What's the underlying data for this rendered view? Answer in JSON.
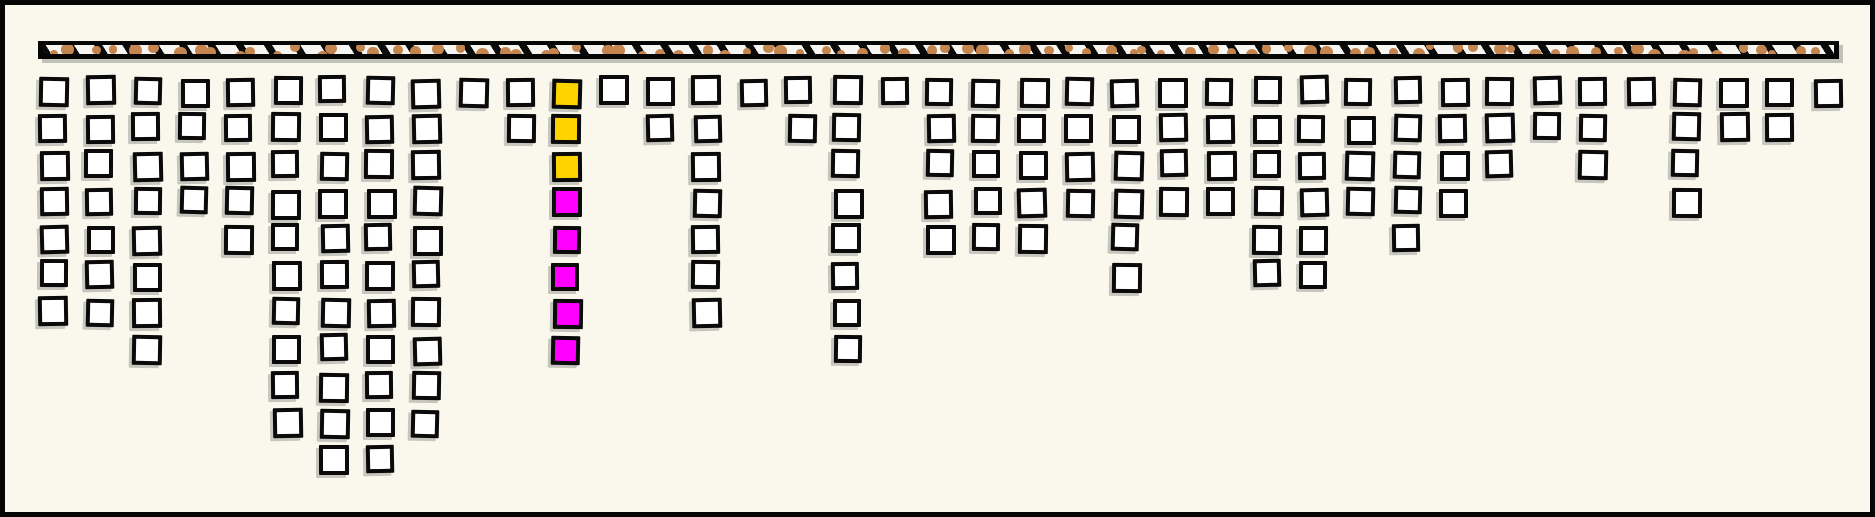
{
  "canvas": {
    "width": 1875,
    "height": 517,
    "background": "#FAF8EC",
    "border_color": "#060606"
  },
  "ceiling_strip": {
    "fill": "#F7F5F1",
    "hatch_style": "diagonal-black-dashes",
    "hatch_color": "#0a0a0a",
    "dot_color": "#C4854F",
    "edge_color": "#060606"
  },
  "cell_style": {
    "fill": "#FFFFFF",
    "edge_color": "#0a0a0a",
    "gold": "#FFD300",
    "magenta": "#FF00FF"
  },
  "chart_data": {
    "type": "bar",
    "variant": "hanging-square-columns",
    "title": "",
    "xlabel": "",
    "ylabel": "",
    "axes": "none",
    "legend": "none",
    "grid": false,
    "categories": [
      1,
      2,
      3,
      4,
      5,
      6,
      7,
      8,
      9,
      10,
      11,
      12,
      13,
      14,
      15,
      16,
      17,
      18,
      19,
      20,
      21,
      22,
      23,
      24,
      25,
      26,
      27,
      28,
      29,
      30,
      31,
      32,
      33,
      34,
      35,
      36,
      37,
      38,
      39
    ],
    "values": [
      7,
      7,
      8,
      4,
      5,
      10,
      11,
      11,
      10,
      1,
      2,
      8,
      1,
      2,
      7,
      1,
      2,
      8,
      1,
      5,
      5,
      5,
      4,
      6,
      4,
      4,
      6,
      6,
      4,
      5,
      4,
      3,
      2,
      3,
      1,
      4,
      2,
      2,
      1
    ],
    "highlight": {
      "column_index": 12,
      "top_gold_squares": 3,
      "bottom_magenta_squares": 5
    },
    "layout": {
      "column_pitch_px": 46.66,
      "row_pitch_px": 36.85,
      "square_size_px": 29,
      "first_column_x_px": 34,
      "first_row_y_px": 72,
      "strip": {
        "x": 33,
        "y": 36,
        "width": 1801,
        "height": 18
      }
    }
  }
}
